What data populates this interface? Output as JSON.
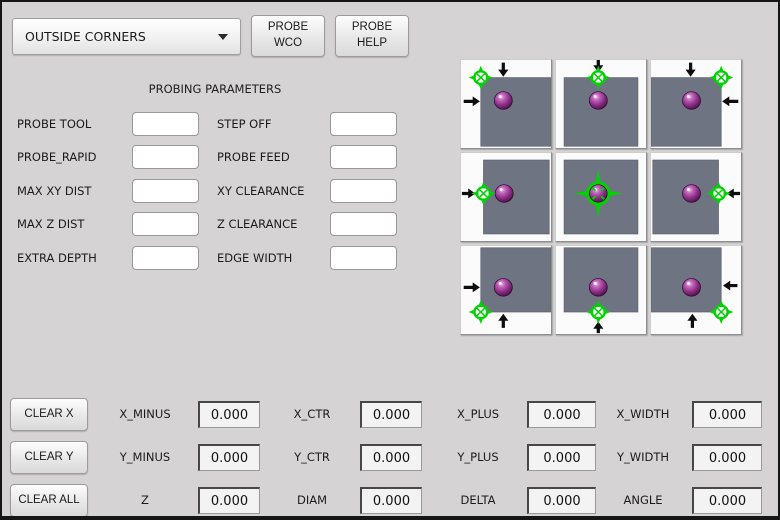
{
  "colors": {
    "background": "#d5d3d3",
    "green": "#00d400",
    "square": "#6f7482",
    "arrow": "#0d0d0d"
  },
  "toolbar": {
    "mode_select_value": "OUTSIDE CORNERS",
    "probe_wco_label": "PROBE\nWCO",
    "probe_help_label": "PROBE\nHELP"
  },
  "parameters": {
    "title": "PROBING PARAMETERS",
    "rows": [
      {
        "left_label": "PROBE TOOL",
        "left_value": "",
        "right_label": "STEP OFF",
        "right_value": ""
      },
      {
        "left_label": "PROBE_RAPID",
        "left_value": "",
        "right_label": "PROBE FEED",
        "right_value": ""
      },
      {
        "left_label": "MAX XY DIST",
        "left_value": "",
        "right_label": "XY CLEARANCE",
        "right_value": ""
      },
      {
        "left_label": "MAX Z DIST",
        "left_value": "",
        "right_label": "Z CLEARANCE",
        "right_value": ""
      },
      {
        "left_label": "EXTRA DEPTH",
        "left_value": "",
        "right_label": "EDGE WIDTH",
        "right_value": ""
      }
    ]
  },
  "probe_grid": {
    "tiles": [
      {
        "name": "top-left",
        "square": [
          22,
          20,
          100,
          98
        ],
        "sphere": [
          47,
          46
        ],
        "crosshair": {
          "type": "corner",
          "x": 22,
          "y": 20
        },
        "arrows": [
          {
            "dir": "down",
            "tip": [
              47,
              19
            ],
            "len": 16
          },
          {
            "dir": "right",
            "tip": [
              21,
              47
            ],
            "len": 18
          }
        ]
      },
      {
        "name": "top-center",
        "square": [
          9,
          20,
          91,
          98
        ],
        "sphere": [
          47,
          46
        ],
        "crosshair": {
          "type": "corner",
          "x": 47,
          "y": 20
        },
        "arrows": [
          {
            "dir": "down",
            "tip": [
              47,
              14
            ],
            "len": 14
          }
        ]
      },
      {
        "name": "top-right",
        "square": [
          0,
          20,
          78,
          98
        ],
        "sphere": [
          45,
          46
        ],
        "crosshair": {
          "type": "corner",
          "x": 78,
          "y": 20
        },
        "arrows": [
          {
            "dir": "down",
            "tip": [
              44,
              19
            ],
            "len": 16
          },
          {
            "dir": "left",
            "tip": [
              79,
              47
            ],
            "len": 18
          }
        ]
      },
      {
        "name": "middle-left",
        "square": [
          25,
          8,
          98,
          92
        ],
        "sphere": [
          48,
          46
        ],
        "crosshair": {
          "type": "corner",
          "x": 25,
          "y": 46
        },
        "arrows": [
          {
            "dir": "right",
            "tip": [
              16,
              46
            ],
            "len": 15
          }
        ]
      },
      {
        "name": "center",
        "square": [
          9,
          8,
          91,
          92
        ],
        "sphere": [
          47,
          46
        ],
        "crosshair": {
          "type": "center",
          "x": 47,
          "y": 46
        },
        "arrows": []
      },
      {
        "name": "middle-right",
        "square": [
          2,
          8,
          75,
          92
        ],
        "sphere": [
          45,
          46
        ],
        "crosshair": {
          "type": "corner",
          "x": 75,
          "y": 46
        },
        "arrows": [
          {
            "dir": "left",
            "tip": [
              84,
              46
            ],
            "len": 15
          }
        ]
      },
      {
        "name": "bottom-left",
        "square": [
          22,
          2,
          100,
          75
        ],
        "sphere": [
          47,
          47
        ],
        "crosshair": {
          "type": "corner",
          "x": 22,
          "y": 75
        },
        "arrows": [
          {
            "dir": "right",
            "tip": [
              21,
              47
            ],
            "len": 18
          },
          {
            "dir": "up",
            "tip": [
              47,
              77
            ],
            "len": 16
          }
        ]
      },
      {
        "name": "bottom-center",
        "square": [
          9,
          2,
          91,
          75
        ],
        "sphere": [
          47,
          47
        ],
        "crosshair": {
          "type": "corner",
          "x": 47,
          "y": 75
        },
        "arrows": [
          {
            "dir": "up",
            "tip": [
              47,
              86
            ],
            "len": 13
          }
        ]
      },
      {
        "name": "bottom-right",
        "square": [
          0,
          2,
          78,
          75
        ],
        "sphere": [
          45,
          47
        ],
        "crosshair": {
          "type": "corner",
          "x": 78,
          "y": 75
        },
        "arrows": [
          {
            "dir": "left",
            "tip": [
              80,
              45
            ],
            "len": 16
          },
          {
            "dir": "up",
            "tip": [
              46,
              77
            ],
            "len": 16
          }
        ]
      }
    ]
  },
  "results": {
    "rows": [
      {
        "button": "CLEAR X",
        "cells": [
          [
            "X_MINUS",
            "0.000"
          ],
          [
            "X_CTR",
            "0.000"
          ],
          [
            "X_PLUS",
            "0.000"
          ],
          [
            "X_WIDTH",
            "0.000"
          ]
        ]
      },
      {
        "button": "CLEAR Y",
        "cells": [
          [
            "Y_MINUS",
            "0.000"
          ],
          [
            "Y_CTR",
            "0.000"
          ],
          [
            "Y_PLUS",
            "0.000"
          ],
          [
            "Y_WIDTH",
            "0.000"
          ]
        ]
      },
      {
        "button": "CLEAR ALL",
        "cells": [
          [
            "Z",
            "0.000"
          ],
          [
            "DIAM",
            "0.000"
          ],
          [
            "DELTA",
            "0.000"
          ],
          [
            "ANGLE",
            "0.000"
          ]
        ]
      }
    ]
  }
}
